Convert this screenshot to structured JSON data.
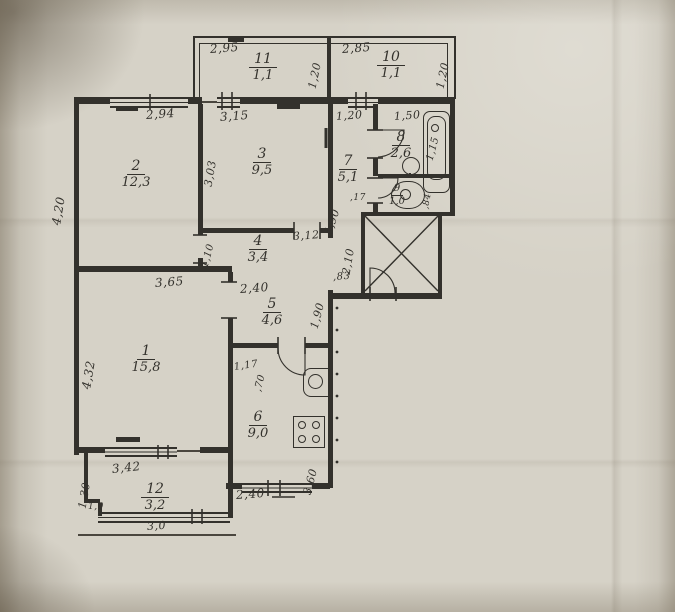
{
  "rooms": [
    {
      "num": "11",
      "area": "1,1"
    },
    {
      "num": "10",
      "area": "1,1"
    },
    {
      "num": "2",
      "area": "12,3"
    },
    {
      "num": "3",
      "area": "9,5"
    },
    {
      "num": "7",
      "area": "5,1"
    },
    {
      "num": "8",
      "area": "2,6"
    },
    {
      "num": "9",
      "area": "1,0"
    },
    {
      "num": "4",
      "area": "3,4"
    },
    {
      "num": "5",
      "area": "4,6"
    },
    {
      "num": "1",
      "area": "15,8"
    },
    {
      "num": "6",
      "area": "9,0"
    },
    {
      "num": "12",
      "area": "3,2"
    }
  ],
  "labels": [
    {
      "text": "2,95"
    },
    {
      "text": "1,20"
    },
    {
      "text": "2,85"
    },
    {
      "text": "1,20"
    },
    {
      "text": "2,94"
    },
    {
      "text": "3,15"
    },
    {
      "text": "1,20"
    },
    {
      "text": "1,50"
    },
    {
      "text": "1,15"
    },
    {
      "text": "4,20"
    },
    {
      "text": "3,03"
    },
    {
      "text": ",17"
    },
    {
      "text": ",84"
    },
    {
      "text": "1,10"
    },
    {
      "text": "3,12"
    },
    {
      "text": "4,90"
    },
    {
      "text": "2,10"
    },
    {
      "text": ",83"
    },
    {
      "text": "3,65"
    },
    {
      "text": "2,40"
    },
    {
      "text": "1,90"
    },
    {
      "text": "4,32"
    },
    {
      "text": "1,17"
    },
    {
      "text": ",70"
    },
    {
      "text": "3,60"
    },
    {
      "text": "2,40"
    },
    {
      "text": "3,42"
    },
    {
      "text": "1,30"
    },
    {
      "text": "1,0"
    },
    {
      "text": "3,0"
    }
  ]
}
